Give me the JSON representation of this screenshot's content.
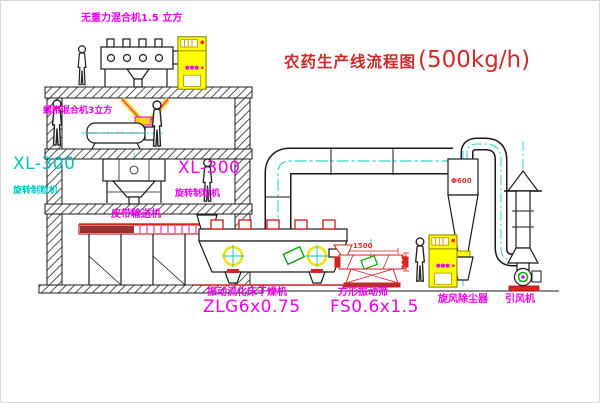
{
  "title": {
    "text": "农药生产线流程图",
    "capacity": "(500kg/h)"
  },
  "labels": {
    "top_mixer": "无重力混合机1.5 立方",
    "mid_mixer": "螺带混合机3立方",
    "granulator_left_model": "XL-300",
    "granulator_left_name": "旋转制粒机",
    "granulator_mid_model": "XL-300",
    "granulator_mid_name": "旋转制粒机",
    "belt_conveyor": "皮带输送机",
    "dryer_name": "振动流化床干燥机",
    "dryer_model": "ZLG6x0.75",
    "sieve_name": "方形振动筛",
    "sieve_model": "FS0.6x1.5",
    "cyclone": "旋风除尘器",
    "fan": "引风机"
  },
  "dimensions": {
    "sieve_length": "1500",
    "sieve_height": "500",
    "cyclone_diameter": "Φ600"
  },
  "colors": {
    "label_magenta": "#ee00ee",
    "label_cyan": "#00c4c4",
    "title_red": "#cd2b2b",
    "dimension_red": "#e03030",
    "cabinet_yellow": "#ffff00"
  }
}
